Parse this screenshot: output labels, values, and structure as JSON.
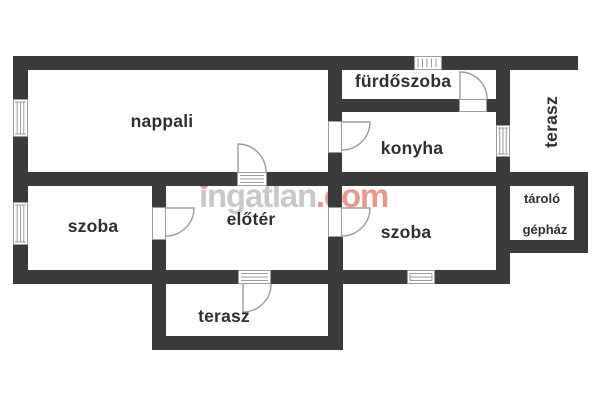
{
  "plan": {
    "type": "floor-plan",
    "background": "#ffffff",
    "colors": {
      "wall": "#3b3b3b",
      "fixture_outline": "#9b9b9b",
      "label_text": "#2f2f2f",
      "watermark_gray": "#c8c8c8",
      "watermark_accent": "#e8998f"
    },
    "fixtures": {
      "windows": 5,
      "door_swings": 6,
      "glazed_door_panels": 2
    }
  },
  "watermark": {
    "brand": "ingatlan",
    "suffix": ".com"
  },
  "rooms": [
    {
      "id": "nappali",
      "label": "nappali"
    },
    {
      "id": "furdoszoba",
      "label": "fürdőszoba"
    },
    {
      "id": "konyha",
      "label": "konyha"
    },
    {
      "id": "terasz-right",
      "label": "terasz"
    },
    {
      "id": "szoba-left",
      "label": "szoba"
    },
    {
      "id": "eloter",
      "label": "előtér"
    },
    {
      "id": "szoba-right",
      "label": "szoba"
    },
    {
      "id": "tarolo",
      "label": "tároló"
    },
    {
      "id": "gephaz",
      "label": "gépház"
    },
    {
      "id": "terasz-bottom",
      "label": "terasz"
    }
  ]
}
